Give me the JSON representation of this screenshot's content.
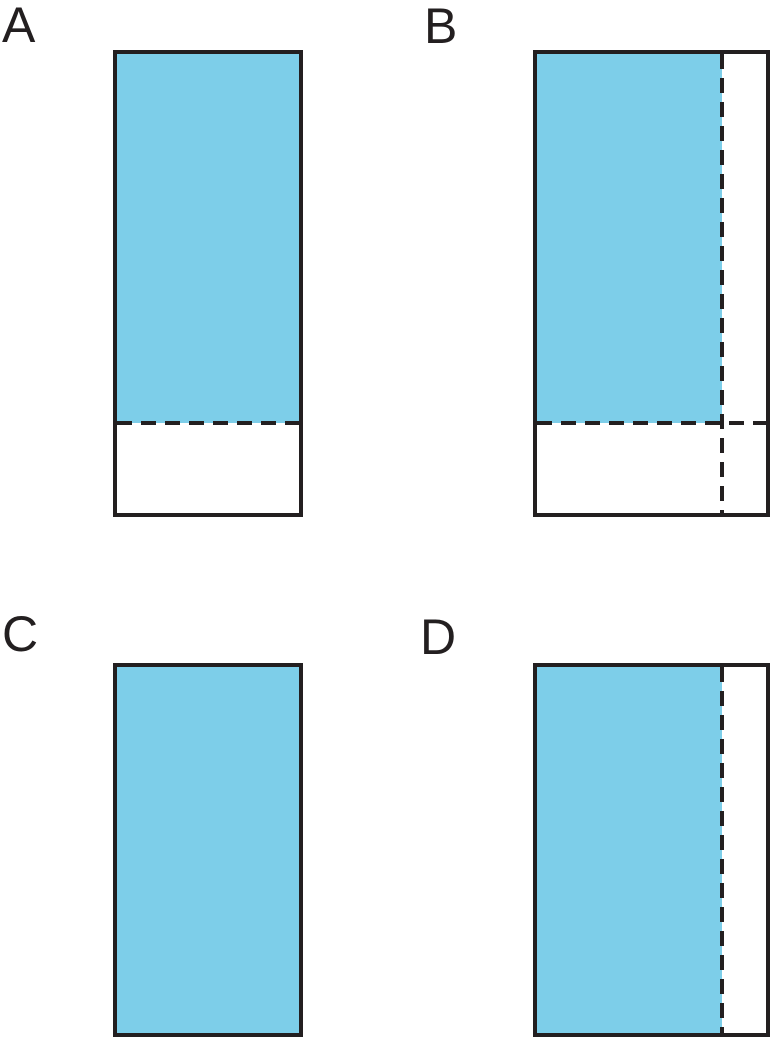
{
  "page": {
    "background": "#FFFFFF"
  },
  "colors": {
    "shaded": "#7DCEE9",
    "outline": "#231F20",
    "background": "#FFFFFF"
  },
  "diagram": {
    "type": "fraction-area-rectangles",
    "stroke_width": 4,
    "dash": {
      "length": 15,
      "gap": 9
    },
    "shapes": [
      {
        "label": "A",
        "label_pos": {
          "x": 2,
          "y": 0
        },
        "rect": {
          "x": 113,
          "y": 50,
          "w": 190,
          "h": 467
        },
        "shaded": {
          "w": 182,
          "h": 369
        },
        "dashed_lines": [
          {
            "orientation": "horizontal",
            "position": 367
          }
        ]
      },
      {
        "label": "B",
        "label_pos": {
          "x": 424,
          "y": 1
        },
        "rect": {
          "x": 533,
          "y": 50,
          "w": 237,
          "h": 467
        },
        "shaded": {
          "w": 185,
          "h": 369
        },
        "dashed_lines": [
          {
            "orientation": "horizontal",
            "position": 367
          },
          {
            "orientation": "vertical",
            "position": 183
          }
        ]
      },
      {
        "label": "C",
        "label_pos": {
          "x": 2,
          "y": 609
        },
        "rect": {
          "x": 113,
          "y": 663,
          "w": 190,
          "h": 374
        },
        "shaded": {
          "w": 182,
          "h": 366
        },
        "dashed_lines": []
      },
      {
        "label": "D",
        "label_pos": {
          "x": 420,
          "y": 612
        },
        "rect": {
          "x": 533,
          "y": 663,
          "w": 237,
          "h": 374
        },
        "shaded": {
          "w": 185,
          "h": 366
        },
        "dashed_lines": [
          {
            "orientation": "vertical",
            "position": 183
          }
        ]
      }
    ]
  }
}
